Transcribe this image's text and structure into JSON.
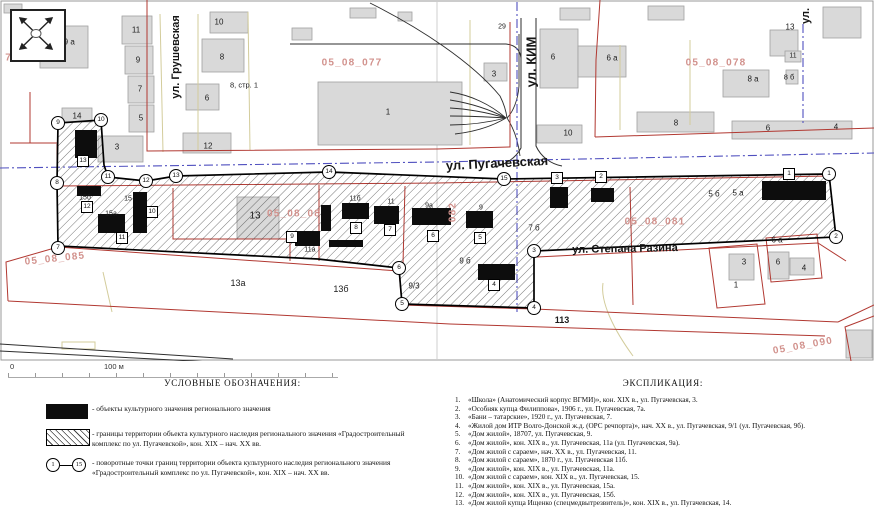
{
  "colors": {
    "heritage_object_black": "#0d0d0d",
    "boundary_red": "#b13831",
    "cadastral_pink": "#d2928d",
    "city_boundary_blue": "#5050bf",
    "background_building_gray": "#d9d9d9"
  },
  "map": {
    "scale_bar": {
      "start": "0",
      "end": "100 м"
    },
    "street_labels": [
      {
        "t": "ул. Грушевская",
        "x": 176,
        "y": 57,
        "r": -90,
        "s": 11
      },
      {
        "t": "ул. КИМ",
        "x": 531,
        "y": 62,
        "r": -90,
        "s": 13
      },
      {
        "t": "ул. Пугачевская",
        "x": 497,
        "y": 163,
        "r": -3,
        "s": 13
      },
      {
        "t": "ул. Степана Разина",
        "x": 625,
        "y": 249,
        "r": -1,
        "s": 11
      },
      {
        "t": "ул.",
        "x": 806,
        "y": 16,
        "r": -90,
        "s": 11
      }
    ],
    "cadastral_labels": [
      {
        "t": "76",
        "x": 12,
        "y": 58,
        "r": 0
      },
      {
        "t": "05_08_077",
        "x": 352,
        "y": 63,
        "r": 0
      },
      {
        "t": "05_08_078",
        "x": 716,
        "y": 63,
        "r": 0
      },
      {
        "t": "05_08_08",
        "x": 294,
        "y": 214,
        "r": 0
      },
      {
        "t": "082",
        "x": 453,
        "y": 212,
        "r": -90
      },
      {
        "t": "05_08_081",
        "x": 655,
        "y": 222,
        "r": 0
      },
      {
        "t": "05_08_085",
        "x": 55,
        "y": 259,
        "r": -6
      },
      {
        "t": "05_08_090",
        "x": 803,
        "y": 346,
        "r": -10
      }
    ],
    "building_labels": [
      {
        "t": "19 а",
        "x": 67,
        "y": 42,
        "s": 8
      },
      {
        "t": "11",
        "x": 136,
        "y": 30,
        "s": 8
      },
      {
        "t": "9",
        "x": 138,
        "y": 60,
        "s": 8
      },
      {
        "t": "7",
        "x": 140,
        "y": 89,
        "s": 8
      },
      {
        "t": "5",
        "x": 141,
        "y": 118,
        "s": 8
      },
      {
        "t": "10",
        "x": 219,
        "y": 22,
        "s": 8
      },
      {
        "t": "8",
        "x": 222,
        "y": 57,
        "s": 8
      },
      {
        "t": "8, стр. 1",
        "x": 244,
        "y": 85,
        "s": 7.5
      },
      {
        "t": "6",
        "x": 207,
        "y": 98,
        "s": 8
      },
      {
        "t": "14",
        "x": 77,
        "y": 116,
        "s": 8
      },
      {
        "t": "3",
        "x": 117,
        "y": 147,
        "s": 8
      },
      {
        "t": "12",
        "x": 208,
        "y": 146,
        "s": 8
      },
      {
        "t": "1",
        "x": 388,
        "y": 112,
        "s": 8
      },
      {
        "t": "3",
        "x": 494,
        "y": 74,
        "s": 8
      },
      {
        "t": "29",
        "x": 502,
        "y": 27,
        "s": 7
      },
      {
        "t": "6",
        "x": 553,
        "y": 57,
        "s": 8
      },
      {
        "t": "10",
        "x": 568,
        "y": 133,
        "s": 8
      },
      {
        "t": "6 а",
        "x": 612,
        "y": 58,
        "s": 8
      },
      {
        "t": "8 а",
        "x": 753,
        "y": 79,
        "s": 8
      },
      {
        "t": "13",
        "x": 790,
        "y": 27,
        "s": 8
      },
      {
        "t": "11",
        "x": 793,
        "y": 56,
        "s": 7
      },
      {
        "t": "8 б",
        "x": 789,
        "y": 77,
        "s": 7.5
      },
      {
        "t": "8",
        "x": 676,
        "y": 123,
        "s": 8
      },
      {
        "t": "6",
        "x": 768,
        "y": 128,
        "s": 8
      },
      {
        "t": "4",
        "x": 836,
        "y": 127,
        "s": 8
      },
      {
        "t": "15б",
        "x": 85,
        "y": 198,
        "s": 7
      },
      {
        "t": "15",
        "x": 128,
        "y": 199,
        "s": 7
      },
      {
        "t": "15а",
        "x": 111,
        "y": 214,
        "s": 7
      },
      {
        "t": "13",
        "x": 255,
        "y": 216,
        "s": 10
      },
      {
        "t": "11б",
        "x": 355,
        "y": 199,
        "s": 7
      },
      {
        "t": "11",
        "x": 391,
        "y": 202,
        "s": 7
      },
      {
        "t": "11а",
        "x": 310,
        "y": 250,
        "s": 7
      },
      {
        "t": "9а",
        "x": 429,
        "y": 206,
        "s": 7
      },
      {
        "t": "9",
        "x": 481,
        "y": 208,
        "s": 7
      },
      {
        "t": "9 б",
        "x": 465,
        "y": 261,
        "s": 8
      },
      {
        "t": "7 б",
        "x": 534,
        "y": 228,
        "s": 8
      },
      {
        "t": "5 б",
        "x": 714,
        "y": 194,
        "s": 8
      },
      {
        "t": "5 а",
        "x": 738,
        "y": 193,
        "s": 8
      },
      {
        "t": "13а",
        "x": 238,
        "y": 283,
        "s": 9
      },
      {
        "t": "13б",
        "x": 341,
        "y": 289,
        "s": 9
      },
      {
        "t": "9/3",
        "x": 414,
        "y": 286,
        "s": 8
      },
      {
        "t": "113",
        "x": 562,
        "y": 320,
        "s": 9,
        "b": true
      },
      {
        "t": "3",
        "x": 744,
        "y": 262,
        "s": 8
      },
      {
        "t": "6",
        "x": 778,
        "y": 262,
        "s": 8
      },
      {
        "t": "4",
        "x": 804,
        "y": 268,
        "s": 8
      },
      {
        "t": "6 а",
        "x": 777,
        "y": 240,
        "s": 8
      },
      {
        "t": "1",
        "x": 736,
        "y": 285,
        "s": 8
      }
    ],
    "turning_points": [
      {
        "n": "1",
        "x": 829,
        "y": 174
      },
      {
        "n": "2",
        "x": 836,
        "y": 237
      },
      {
        "n": "3",
        "x": 534,
        "y": 251
      },
      {
        "n": "4",
        "x": 534,
        "y": 308
      },
      {
        "n": "5",
        "x": 402,
        "y": 304
      },
      {
        "n": "6",
        "x": 399,
        "y": 268
      },
      {
        "n": "7",
        "x": 58,
        "y": 248
      },
      {
        "n": "8",
        "x": 57,
        "y": 183
      },
      {
        "n": "9",
        "x": 58,
        "y": 123
      },
      {
        "n": "10",
        "x": 101,
        "y": 120
      },
      {
        "n": "11",
        "x": 108,
        "y": 177
      },
      {
        "n": "12",
        "x": 146,
        "y": 181
      },
      {
        "n": "13",
        "x": 176,
        "y": 176
      },
      {
        "n": "14",
        "x": 329,
        "y": 172
      },
      {
        "n": "15",
        "x": 504,
        "y": 179
      }
    ],
    "object_markers": [
      {
        "n": "1",
        "x": 789,
        "y": 174
      },
      {
        "n": "2",
        "x": 601,
        "y": 177
      },
      {
        "n": "3",
        "x": 557,
        "y": 178
      },
      {
        "n": "4",
        "x": 494,
        "y": 285
      },
      {
        "n": "5",
        "x": 480,
        "y": 238
      },
      {
        "n": "6",
        "x": 433,
        "y": 236
      },
      {
        "n": "7",
        "x": 390,
        "y": 230
      },
      {
        "n": "8",
        "x": 356,
        "y": 228
      },
      {
        "n": "9",
        "x": 292,
        "y": 237
      },
      {
        "n": "10",
        "x": 152,
        "y": 212
      },
      {
        "n": "11",
        "x": 122,
        "y": 238
      },
      {
        "n": "12",
        "x": 87,
        "y": 207
      },
      {
        "n": "13",
        "x": 83,
        "y": 161
      }
    ]
  },
  "legend": {
    "title": "УСЛОВНЫЕ ОБОЗНАЧЕНИЯ:",
    "items": [
      {
        "symbol": "black-rect",
        "text": "- объекты культурного значения регионального значения"
      },
      {
        "symbol": "hatched-rect",
        "text": "- границы территории объекта культурного наследия регионального значения «Градостроительный комплекс по ул. Пугачевской», кон. XIX – нач. XX вв."
      },
      {
        "symbol": "point-range",
        "range_start": "1",
        "range_end": "15",
        "text": "- поворотные точки границ территории объекта культурного наследия регионального значения «Градостроительный комплекс по ул. Пугачевской», кон. XIX – нач. XX вв."
      }
    ]
  },
  "explication": {
    "title": "ЭКСПЛИКАЦИЯ:",
    "items": [
      {
        "num": "1.",
        "text": "«Школа» (Анатомический корпус ВГМИ)», кон. XIX в., ул. Пугачевская, 3."
      },
      {
        "num": "2.",
        "text": "«Особняк купца Филиппова», 1906 г., ул. Пугачевская, 7а."
      },
      {
        "num": "3.",
        "text": "«Бани – татарские», 1920 г., ул. Пугачевская, 7."
      },
      {
        "num": "4.",
        "text": "«Жилой дом ИТР Волго-Донской ж.д. (ОРС речпорта)», нач. XX в., ул. Пугачевская, 9/1 (ул. Пугачевская, 9б)."
      },
      {
        "num": "5.",
        "text": "«Дом жилой», 18707, ул. Пугачевская, 9."
      },
      {
        "num": "6.",
        "text": "«Дом жилой», кон. XIX в., ул. Пугачевская, 11а (ул. Пугачевская, 9а)."
      },
      {
        "num": "7.",
        "text": "«Дом жилой с сараем», нач. XX в., ул. Пугачевская, 11."
      },
      {
        "num": "8.",
        "text": "«Дом жилой с сараем», 1870 г., ул. Пугачевская 11б."
      },
      {
        "num": "9.",
        "text": "«Дом жилой», кон. XIX в., ул. Пугачевская, 11а."
      },
      {
        "num": "10.",
        "text": "«Дом жилой с сараем», кон. XIX в., ул. Пугачевская, 15."
      },
      {
        "num": "11.",
        "text": "«Дом жилой», кон. XIX в., ул. Пугачевская, 15а."
      },
      {
        "num": "12.",
        "text": "«Дом жилой», кон. XIX в., ул. Пугачевская, 15б."
      },
      {
        "num": "13.",
        "text": "«Дом жилой купца Ищенко (спецмедвытрезвитель)», кон. XIX в., ул. Пугачевская, 14."
      }
    ]
  }
}
